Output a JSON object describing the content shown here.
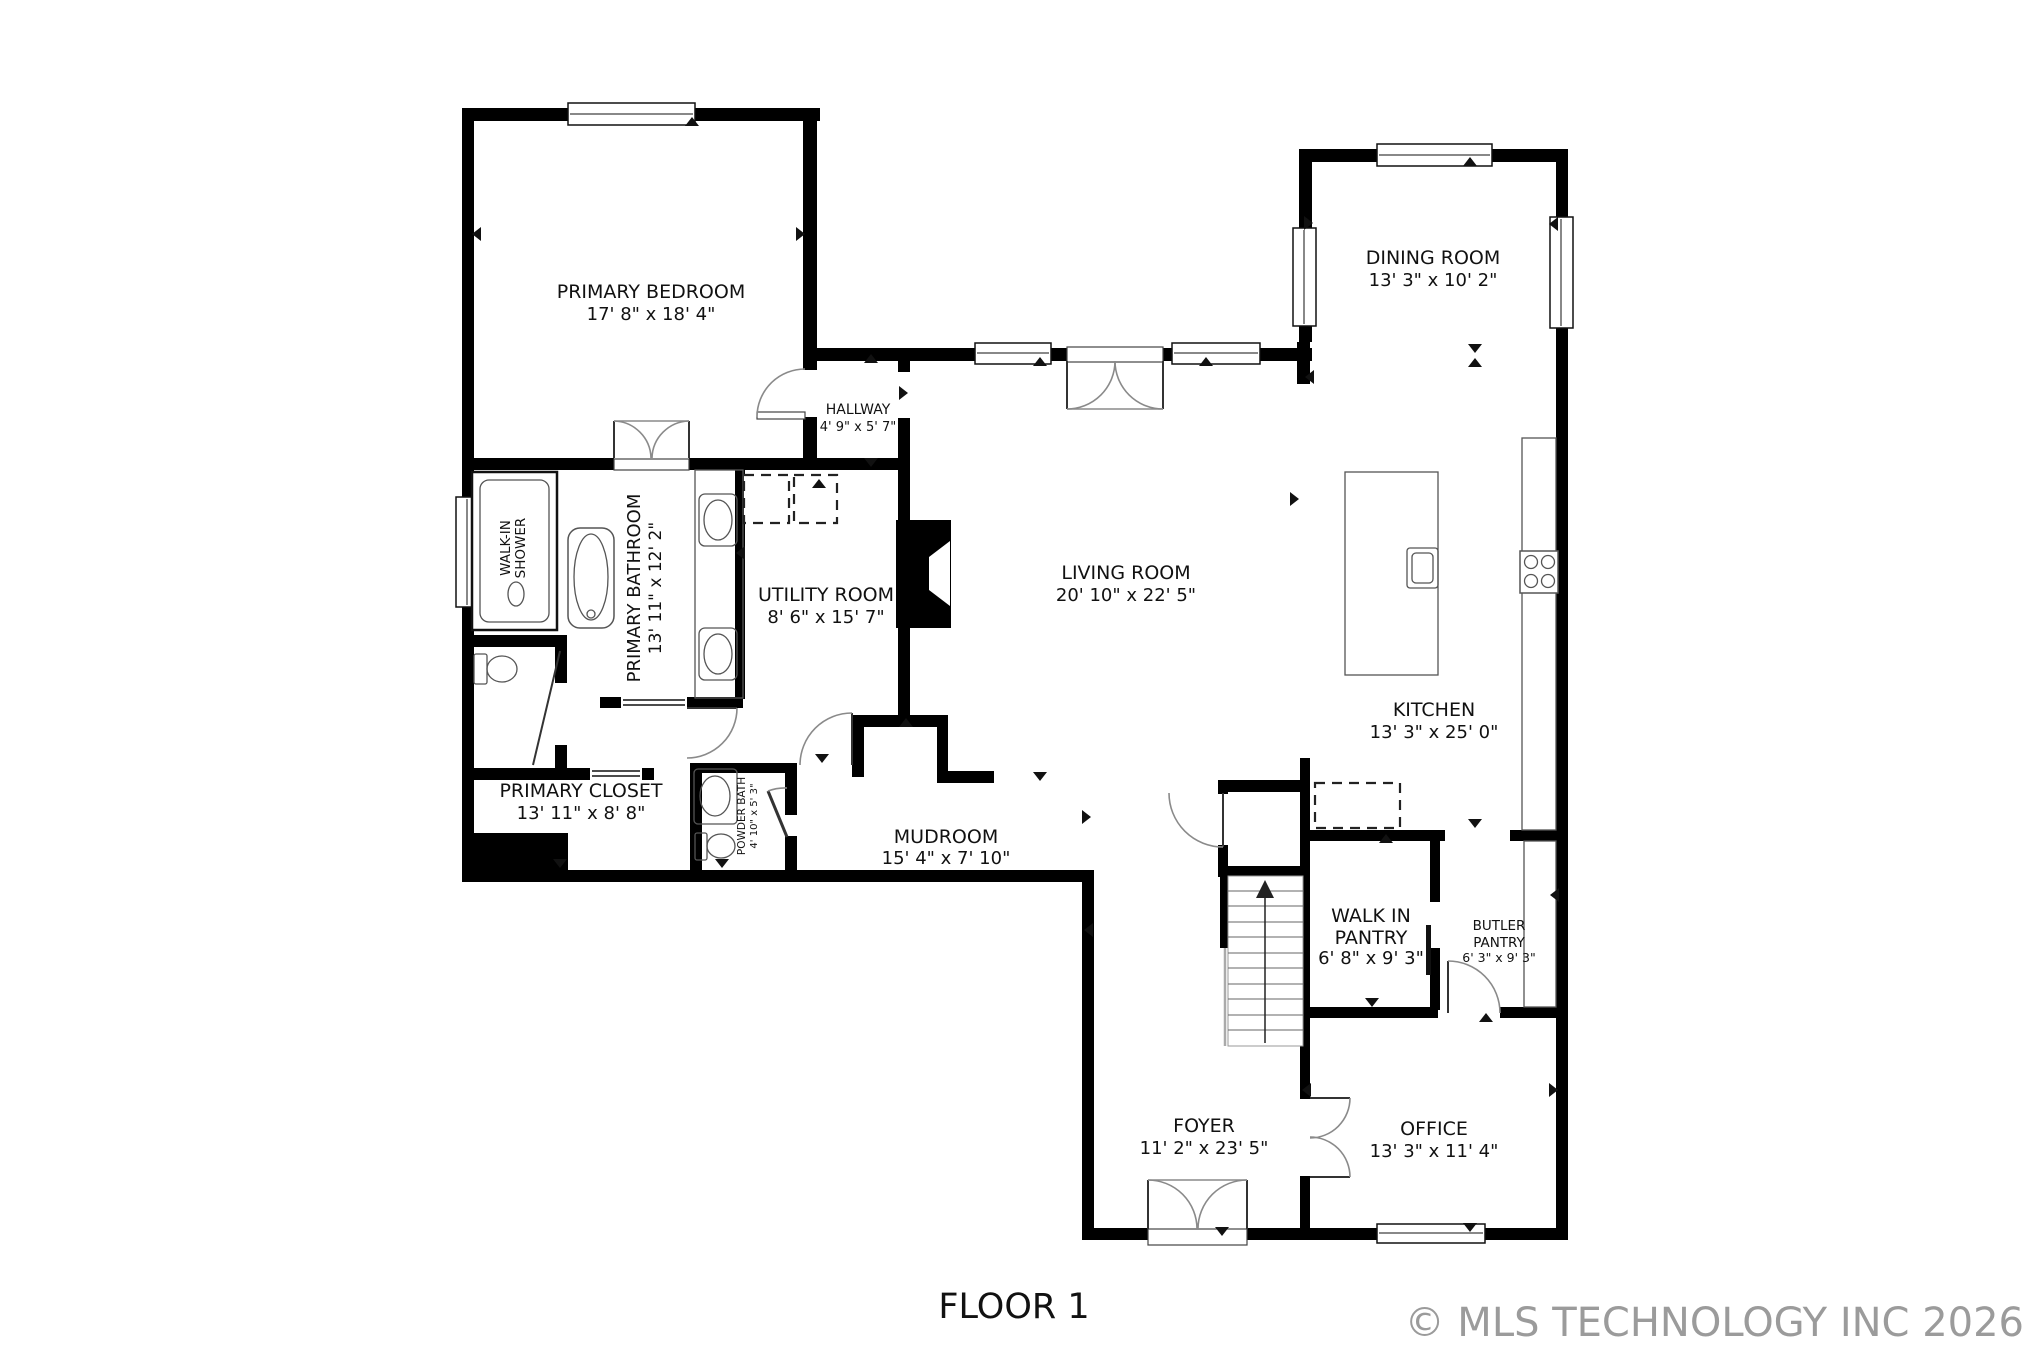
{
  "footer": {
    "floor_label": "FLOOR 1",
    "copyright": "© MLS TECHNOLOGY INC 2026"
  },
  "colors": {
    "wall": "#000000",
    "text": "#111111",
    "fixture_line": "#555555",
    "door_arc": "#8a8a8a",
    "copyright_text": "#9b9b9b",
    "background": "#ffffff"
  },
  "rooms": {
    "primary_bedroom": {
      "name": "PRIMARY BEDROOM",
      "dims": "17' 8\" x 18' 4\""
    },
    "hallway": {
      "name": "HALLWAY",
      "dims": "4' 9\" x 5' 7\""
    },
    "dining_room": {
      "name": "DINING ROOM",
      "dims": "13' 3\" x 10' 2\""
    },
    "living_room": {
      "name": "LIVING ROOM",
      "dims": "20' 10\" x 22' 5\""
    },
    "kitchen": {
      "name": "KITCHEN",
      "dims": "13' 3\" x 25' 0\""
    },
    "utility_room": {
      "name": "UTILITY ROOM",
      "dims": "8' 6\" x 15' 7\""
    },
    "primary_bathroom": {
      "name": "PRIMARY BATHROOM",
      "dims": "13' 11\" x 12' 2\""
    },
    "walk_in_shower": {
      "line1": "WALK-IN",
      "line2": "SHOWER"
    },
    "primary_closet": {
      "name": "PRIMARY CLOSET",
      "dims": "13' 11\" x 8' 8\""
    },
    "powder_bath": {
      "name": "POWDER BATH",
      "dims": "4' 10\" x 5' 3\""
    },
    "mudroom": {
      "name": "MUDROOM",
      "dims": "15' 4\" x 7' 10\""
    },
    "walk_in_pantry": {
      "line1": "WALK IN",
      "line2": "PANTRY",
      "dims": "6' 8\" x 9' 3\""
    },
    "butler_pantry": {
      "line1": "BUTLER",
      "line2": "PANTRY",
      "dims": "6' 3\" x 9' 3\""
    },
    "foyer": {
      "name": "FOYER",
      "dims": "11' 2\" x 23' 5\""
    },
    "office": {
      "name": "OFFICE",
      "dims": "13' 3\" x 11' 4\""
    }
  },
  "fixtures": [
    "walk-in-shower",
    "bathtub",
    "double-vanity-sinks",
    "toilet",
    "powder-sink",
    "powder-toilet",
    "washer-dryer-dashed",
    "refrigerator-dashed",
    "kitchen-island-with-sink",
    "range-stove",
    "kitchen-counter",
    "butler-counter",
    "stairs-up-arrow",
    "fireplace",
    "closet-built-in"
  ]
}
